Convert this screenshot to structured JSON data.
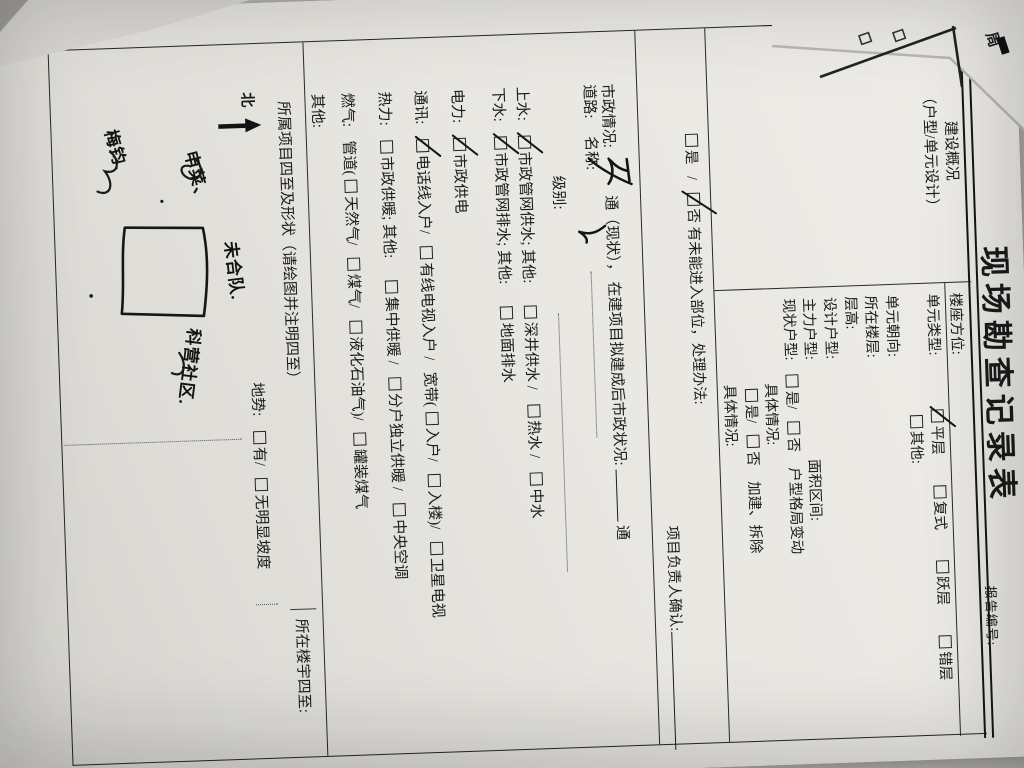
{
  "title": {
    "text": "现场勘查记录表",
    "report_no": "报告编号:"
  },
  "s1": {
    "h1": "建设概况",
    "h2": "（户型/单元设计）",
    "louzuo": "楼座方位:",
    "unit_type": "单元类型:",
    "pingceng": "平层",
    "fushi": "复式",
    "yueceng": "跃层",
    "cuoceng": "错层",
    "qita": "其他:",
    "chaoxiang": "单元朝向:",
    "louceng": "所在楼层:",
    "cenggao": "层高:",
    "sheji": "设计户型:",
    "zhuli": "主力户型:",
    "mianji": "面积区间:",
    "xianzhuang": "现状户型:",
    "shi": "是/",
    "fou": "否",
    "geju": "户型格局变动",
    "juti1": "具体情况:",
    "shi2": "是/",
    "fou2": "否",
    "jiajian": "加建、拆除",
    "juti2": "具体情况:"
  },
  "s2": {
    "shi": "是",
    "slash": "/",
    "fou": "否",
    "text": "有未能进入部位，处理办法:",
    "confirm": "项目负责人确认:"
  },
  "s3": {
    "label": "市政情况:",
    "hw": "五",
    "tong1": "通（现状），",
    "plan": "在建项目拟建成后市政状况:",
    "tong2": "通",
    "daolu": "道路:",
    "mingcheng": "名称:",
    "jibie": "级别:",
    "shangshui": "上水:",
    "ss1": "市政管网供水; 其他:",
    "ss2": "深井供水 /",
    "ss3": "热水 /",
    "ss4": "中水",
    "xiashui": "下水:",
    "xs1": "市政管网排水; 其他:",
    "xs2": "地面排水",
    "dianli": "电力:",
    "dl1": "市政供电",
    "tongxun": "通讯:",
    "tx1": "电话线入户/",
    "tx2": "有线电视入户 /",
    "tx3": "宽带(",
    "tx4": "入户/",
    "tx5": "入楼)/",
    "tx6": "卫星电视",
    "reli": "热力:",
    "rl1": "市政供暖; 其他:",
    "rl2": "集中供暖 /",
    "rl3": "分户独立供暖 /",
    "rl4": "中央空调",
    "ranqi": "燃气:",
    "rq1": "管道(",
    "rq2": "天然气/",
    "rq3": "煤气/",
    "rq4": "液化石油气)/",
    "rq5": "罐装煤气",
    "qita": "其他:"
  },
  "s4": {
    "heading": "所属项目四至及形状（请绘图并注明四至）",
    "louyu": "所在楼宇四至:",
    "north": "北",
    "dishi": "地势:",
    "you": "有/",
    "wu": "无明显坡度",
    "note_top": "未合队.",
    "note_left1": "申菜、",
    "note_left2": "梅钧.",
    "note_right": "科营社区."
  },
  "fragment": {
    "zhou": "周"
  }
}
